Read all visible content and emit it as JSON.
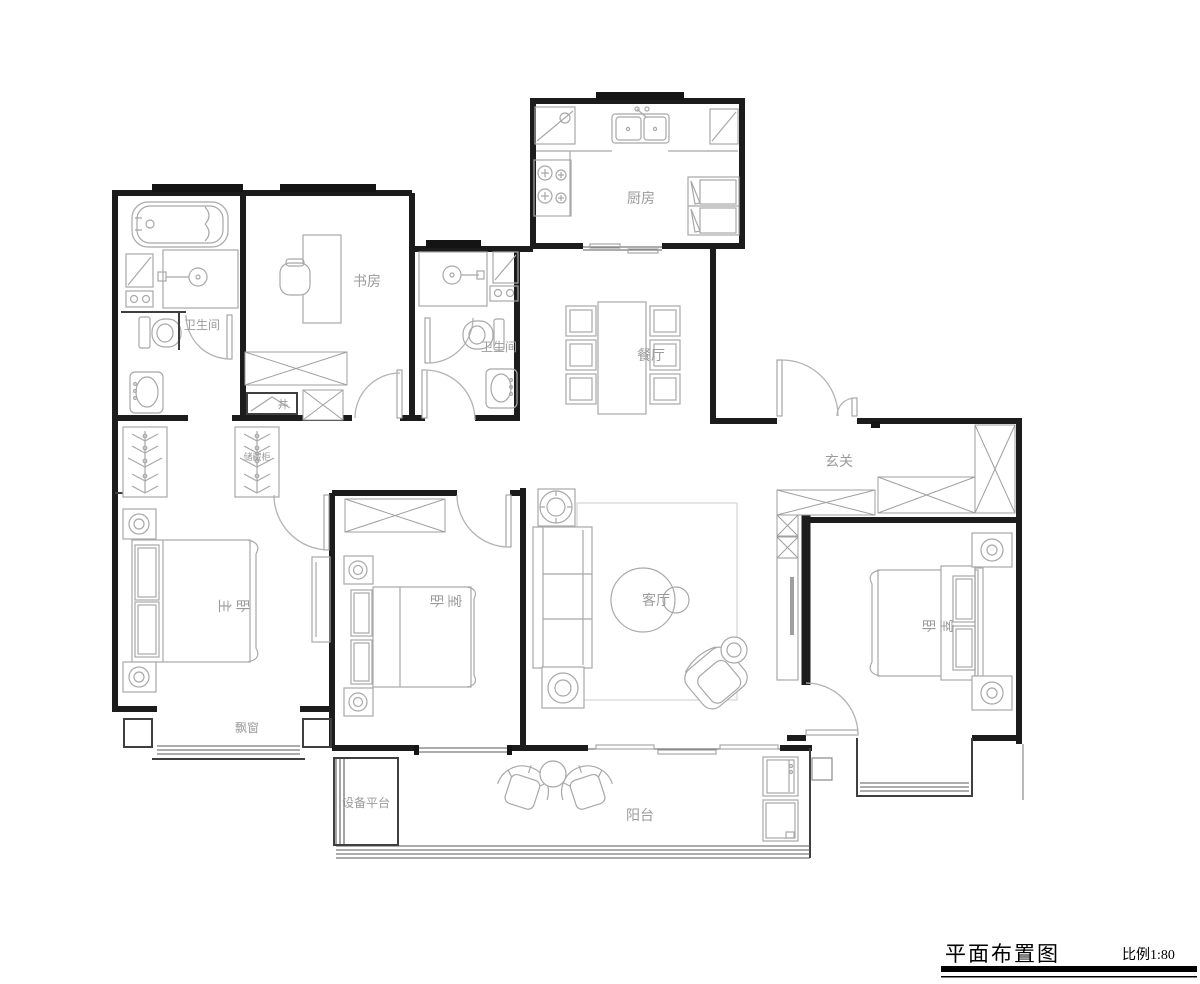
{
  "document": {
    "type": "residential floor plan"
  },
  "title_block": {
    "title": "平面布置图",
    "scale_label": "比例1:80"
  },
  "room_labels": {
    "kitchen": "厨房",
    "dining": "餐厅",
    "study": "书房",
    "bathroom_main": "卫生间",
    "bathroom_second": "卫生间",
    "shaft": "井",
    "entry": "玄关",
    "master_bedroom": "主卧",
    "bedroom_middle": "卧室",
    "bedroom_right": "卧室",
    "living": "客厅",
    "bay_window": "飘窗",
    "equipment_platform": "设备平台",
    "balcony": "阳台",
    "storage_cabinet": "储藏柜"
  },
  "colors": {
    "wall": "#1c1c1c",
    "furniture_line": "#a8a8a8",
    "label_text": "#9b9b9b",
    "title_text": "#000000",
    "background": "#ffffff"
  }
}
